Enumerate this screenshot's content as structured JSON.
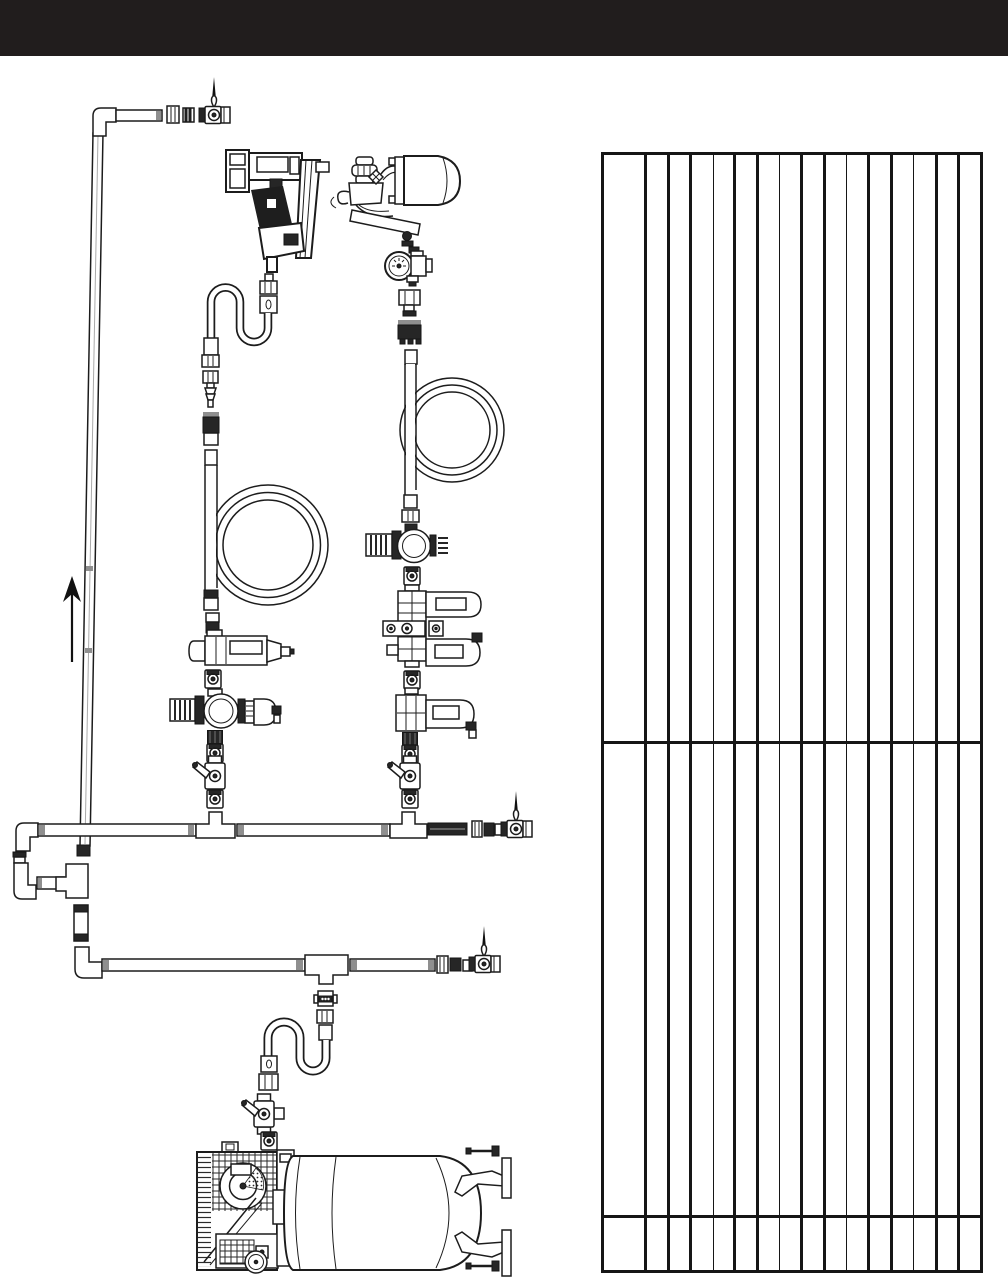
{
  "page": {
    "width": 1008,
    "height": 1277,
    "background_color": "#ffffff"
  },
  "header": {
    "background_color": "#211d1d",
    "height": 56,
    "title": ""
  },
  "diagram": {
    "line_color": "#1c1c1c",
    "components": [
      "shutoff-ball-valve-top",
      "riser-pipe",
      "flow-direction-arrow",
      "framing-nail-gun",
      "paint-spray-gun",
      "spray-gun-regulator-gauge",
      "whip-hose",
      "air-plug-fitting",
      "quick-coupler",
      "recoil-hose-left",
      "recoil-hose-right",
      "inline-filter",
      "regulator-with-gauge-left",
      "regulator-with-gauge-right",
      "piggyback-filter-lubricator",
      "inline-lubricator",
      "branch-tee-left",
      "branch-tee-right",
      "branch-ball-valve-left",
      "branch-ball-valve-right",
      "main-header-pipe",
      "drop-leg-tee",
      "drain-nipple",
      "secondary-header-pipe",
      "secondary-tee",
      "end-ball-valve-main",
      "end-ball-valve-secondary",
      "gooseneck-hose",
      "tank-drain-ball-valve",
      "air-compressor"
    ]
  },
  "table": {
    "left": 601,
    "top": 152,
    "width": 382,
    "height": 1121,
    "border_color": "#161616",
    "outer_border_px": 3.5,
    "column_lines": [
      {
        "x": 45,
        "w": 3
      },
      {
        "x": 68,
        "w": 2.2
      },
      {
        "x": 90,
        "w": 2.2
      },
      {
        "x": 113,
        "w": 1
      },
      {
        "x": 134,
        "w": 3
      },
      {
        "x": 157,
        "w": 2.2
      },
      {
        "x": 179,
        "w": 1.6
      },
      {
        "x": 201,
        "w": 2.6
      },
      {
        "x": 224,
        "w": 2.2
      },
      {
        "x": 246,
        "w": 1.6
      },
      {
        "x": 268,
        "w": 2.6
      },
      {
        "x": 291,
        "w": 2.2
      },
      {
        "x": 313,
        "w": 1
      },
      {
        "x": 336,
        "w": 2.2
      },
      {
        "x": 358,
        "w": 2.2
      }
    ],
    "row_lines": [
      {
        "y": 591,
        "w": 3
      },
      {
        "y": 1065,
        "w": 3.5
      }
    ],
    "cells_empty": true
  }
}
